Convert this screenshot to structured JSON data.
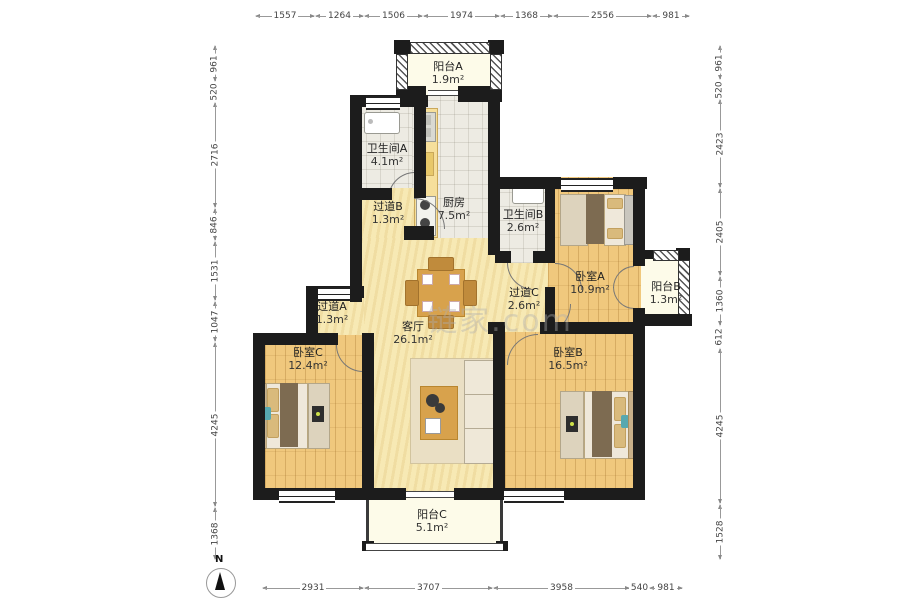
{
  "rooms": {
    "balcony_a": {
      "name": "阳台A",
      "area": "1.9m²"
    },
    "bath_a": {
      "name": "卫生间A",
      "area": "4.1m²"
    },
    "kitchen": {
      "name": "厨房",
      "area": "7.5m²"
    },
    "hall_b": {
      "name": "过道B",
      "area": "1.3m²"
    },
    "bath_b": {
      "name": "卫生间B",
      "area": "2.6m²"
    },
    "bed_a": {
      "name": "卧室A",
      "area": "10.9m²"
    },
    "balcony_b": {
      "name": "阳台B",
      "area": "1.3m²"
    },
    "hall_c": {
      "name": "过道C",
      "area": "2.6m²"
    },
    "hall_a": {
      "name": "过道A",
      "area": "1.3m²"
    },
    "living": {
      "name": "客厅",
      "area": "26.1m²"
    },
    "bed_c": {
      "name": "卧室C",
      "area": "12.4m²"
    },
    "bed_b": {
      "name": "卧室B",
      "area": "16.5m²"
    },
    "balcony_c": {
      "name": "阳台C",
      "area": "5.1m²"
    }
  },
  "dimensions": {
    "top": [
      "1557",
      "1264",
      "1506",
      "1974",
      "1368",
      "2556",
      "981"
    ],
    "bottom": [
      "2931",
      "3707",
      "3958",
      "540",
      "981"
    ],
    "left": [
      "961",
      "520",
      "2716",
      "846",
      "1531",
      "1047",
      "4245",
      "1368"
    ],
    "right": [
      "961",
      "520",
      "2423",
      "2405",
      "1360",
      "612",
      "4245",
      "1528"
    ]
  },
  "compass": {
    "label": "N"
  },
  "watermark": {
    "text": "链家.com"
  },
  "colors": {
    "wall": "#1c1c1c",
    "wood": "#f0c87d",
    "living": "#f7e9b4",
    "balcony": "#fdfbe9"
  }
}
